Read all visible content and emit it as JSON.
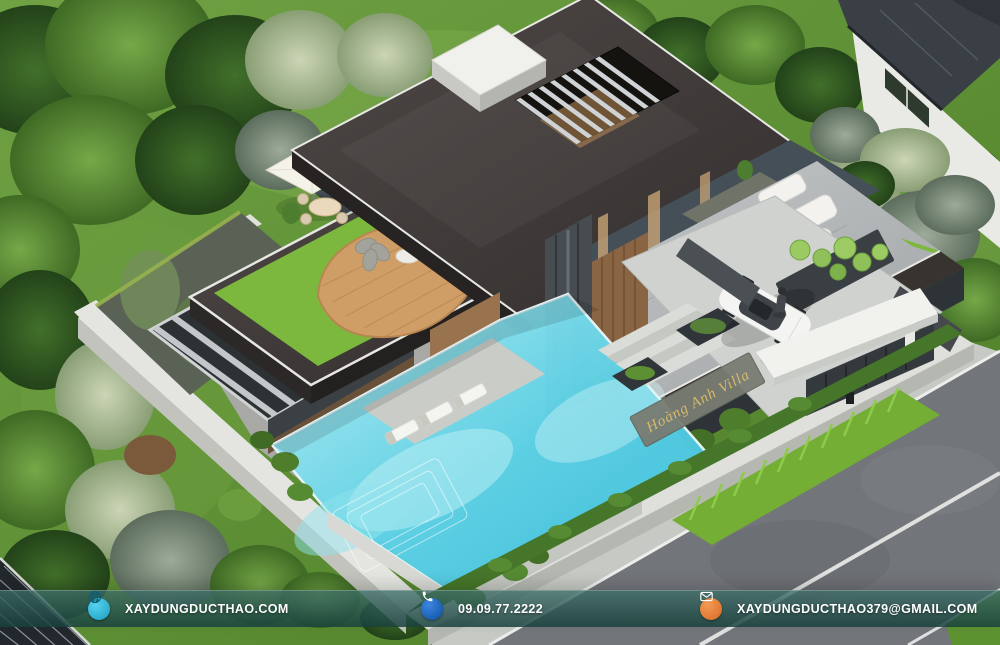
{
  "scene": {
    "villa_nameplate": "Hoàng Anh Villa"
  },
  "footer": {
    "bar_color": "#2a5450",
    "items": [
      {
        "icon": "globe-icon",
        "label": "XAYDUNGDUCTHAO.COM",
        "color": "#2fb9da"
      },
      {
        "icon": "phone-icon",
        "label": "09.09.77.2222",
        "color": "#1566c4"
      },
      {
        "icon": "email-icon",
        "label": "XAYDUNGDUCTHAO379@GMAIL.COM",
        "color": "#e8823c"
      }
    ]
  },
  "palette": {
    "pool_water": "#5bd1e6",
    "roof_dark": "#413b39",
    "terrace_lawn": "#7cb83e",
    "grass_base": "#5e9134",
    "road_asphalt": "#73767b",
    "deck_wood": "#cf9e66"
  }
}
